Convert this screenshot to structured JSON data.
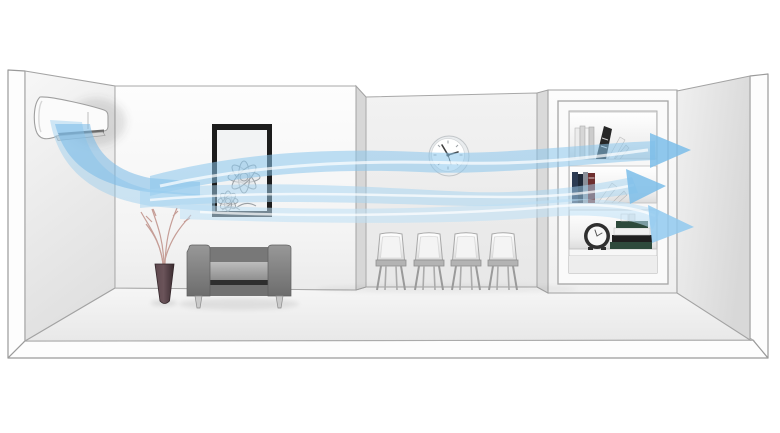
{
  "meta": {
    "aria_label": "Cutaway illustration of a long room: a wall-mounted air conditioner on the left wall blows three light-blue airflow streams with arrowheads across the whole room to the bookshelf wall on the right",
    "description": "Air-conditioner long-reach airflow concept illustration"
  },
  "colors": {
    "background": "#ffffff",
    "outline": "#9a9a9a",
    "wall_light": "#f6f6f6",
    "wall_mid": "#ececec",
    "wall_shade": "#d9d9d9",
    "floor": "#efefef",
    "airflow_light": "#cfe8f8",
    "airflow_mid": "#a3d3f0",
    "airflow_strong": "#7fc0ea",
    "arrow": "#7bbde9",
    "sofa_body": "#828282",
    "sofa_cushion": "#a8a8a8",
    "sofa_gap": "#2e2e2e",
    "vase": "#4b373c",
    "branches": "#c49a93",
    "picture_frame": "#1c1c1c",
    "book_dark": "#272727",
    "book_navy": "#2c3b52",
    "book_maroon": "#6e2f2f",
    "book_green": "#2e4a3c",
    "chair_seat": "#b3b3b3",
    "clock_hand": "#3f3f3f"
  },
  "scene": {
    "objects": [
      {
        "name": "air-conditioner",
        "location": "left wall, top"
      },
      {
        "name": "airflow-streams",
        "count": 3,
        "direction": "left-to-right",
        "arrowheads": 3
      },
      {
        "name": "framed-flower-picture",
        "location": "first wall section"
      },
      {
        "name": "vase-with-branches",
        "location": "floor, left"
      },
      {
        "name": "two-seat-sofa",
        "location": "floor, left"
      },
      {
        "name": "wall-clock",
        "location": "recessed wall section"
      },
      {
        "name": "chairs",
        "count": 4,
        "location": "recessed wall section"
      },
      {
        "name": "recessed-bookshelf",
        "shelves": 3,
        "location": "right pillar"
      },
      {
        "name": "alarm-clock",
        "location": "bookshelf bottom shelf"
      },
      {
        "name": "books",
        "location": "bookshelf shelves"
      }
    ]
  }
}
